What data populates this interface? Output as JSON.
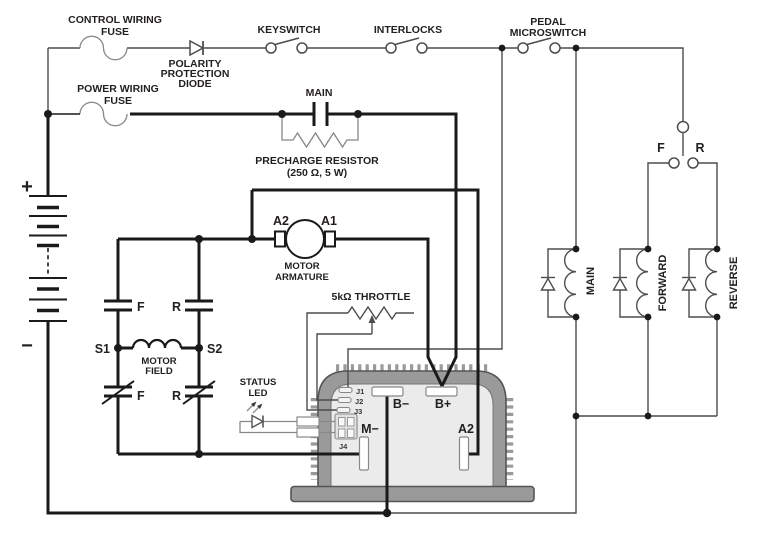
{
  "diagram_type": "motor-controller-wiring-schematic",
  "colors": {
    "background": "#ffffff",
    "wire_power": "#1a1a1a",
    "wire_control": "#4d4d4d",
    "wire_gray": "#888888",
    "controller_wall": "#9a9a9a",
    "controller_face": "#ebebeb",
    "controller_outline": "#555555",
    "text": "#231f20"
  },
  "labels": {
    "control_fuse": [
      "CONTROL WIRING",
      "FUSE"
    ],
    "polarity_diode": [
      "POLARITY",
      "PROTECTION",
      "DIODE"
    ],
    "keyswitch": "KEYSWITCH",
    "interlocks": "INTERLOCKS",
    "pedal_microswitch": [
      "PEDAL",
      "MICROSWITCH"
    ],
    "power_fuse": [
      "POWER WIRING",
      "FUSE"
    ],
    "main_contact": "MAIN",
    "precharge": [
      "PRECHARGE RESISTOR",
      "(250 Ω, 5 W)"
    ],
    "battery_plus": "+",
    "battery_minus": "−",
    "armature_a2": "A2",
    "armature_a1": "A1",
    "motor_armature": [
      "MOTOR",
      "ARMATURE"
    ],
    "throttle": "5kΩ THROTTLE",
    "field_f_top": "F",
    "field_r_top": "R",
    "field_s1": "S1",
    "field_s2": "S2",
    "motor_field": [
      "MOTOR",
      "FIELD"
    ],
    "field_f_bottom": "F",
    "field_r_bottom": "R",
    "status_led": [
      "STATUS",
      "LED"
    ],
    "j1": "J1",
    "j2": "J2",
    "j3": "J3",
    "j4": "J4",
    "b_minus": "B−",
    "b_plus": "B+",
    "m_minus": "M−",
    "a2_terminal": "A2",
    "fr_switch_f": "F",
    "fr_switch_r": "R",
    "coil_main": "MAIN",
    "coil_forward": "FORWARD",
    "coil_reverse": "REVERSE"
  }
}
